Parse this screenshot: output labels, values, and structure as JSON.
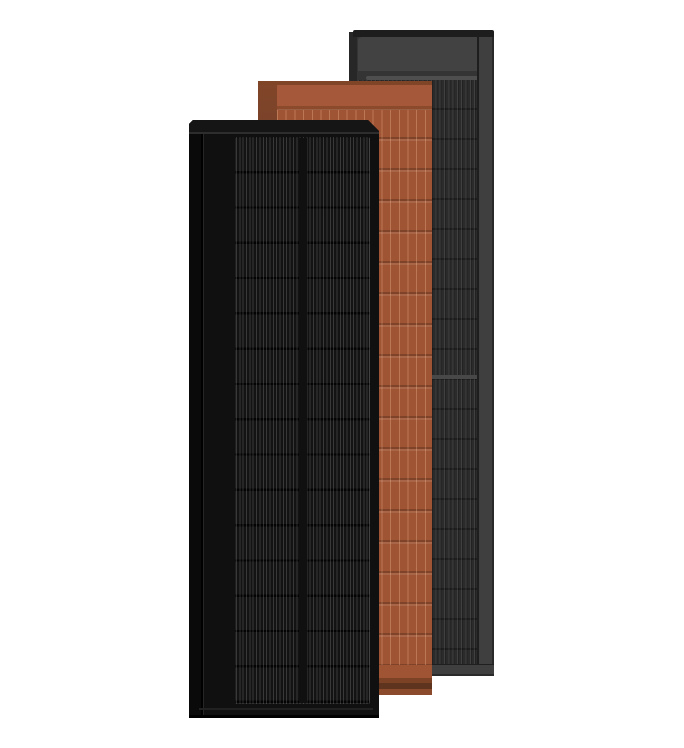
{
  "scene": {
    "description": "Product render of three overlapping tall solar roof panels on a white background",
    "background_color": "#ffffff",
    "panels": [
      {
        "name": "slate-gray-solar-panel",
        "position": "back",
        "top_bar_color": "#1d1d1d",
        "side_color": "#272727",
        "header_color": "#424242",
        "cell_color": "#2b2b2b",
        "frame_color": "#3f3f3f"
      },
      {
        "name": "terracotta-solar-panel",
        "position": "middle",
        "tile_color": "#9f5433",
        "band_color": "#a5593a",
        "side_color": "#7a4228",
        "shadow_color": "#5f341e"
      },
      {
        "name": "matte-black-solar-panel",
        "position": "front",
        "body_color": "#101010",
        "top_bar_color": "#151515",
        "cell_color": "#131313",
        "side_color": "#0a0a0a"
      }
    ]
  }
}
